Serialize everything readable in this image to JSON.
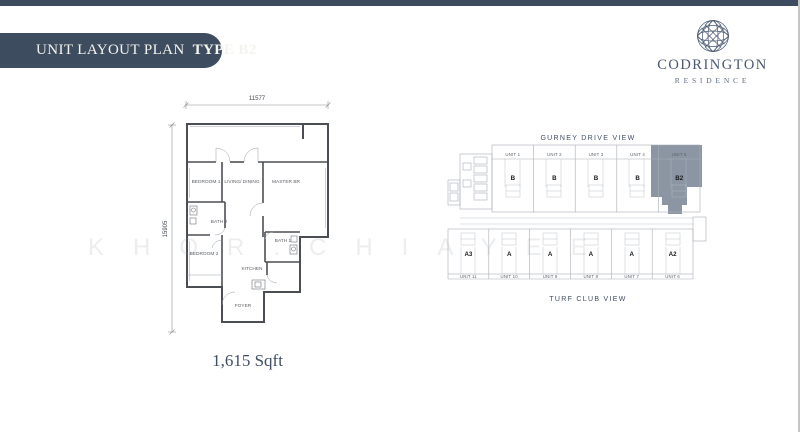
{
  "banner": {
    "title": "UNIT LAYOUT PLAN",
    "unit_type": "TYPE B2"
  },
  "logo": {
    "name": "CODRINGTON",
    "subtitle": "RESIDENCE"
  },
  "floor_plan": {
    "width_dim": "11577",
    "height_dim": "15905",
    "area": "1,615 Sqft",
    "rooms": [
      "BEDROOM 1",
      "LIVING/ DINING",
      "MASTER BR",
      "BATH 2",
      "BEDROOM 2",
      "BATH 1",
      "KITCHEN",
      "FOYER"
    ]
  },
  "site_plan": {
    "top_view_label": "GURNEY DRIVE VIEW",
    "bottom_view_label": "TURF CLUB VIEW",
    "top_units": [
      {
        "name": "UNIT 1",
        "type": "B"
      },
      {
        "name": "UNIT 2",
        "type": "B"
      },
      {
        "name": "UNIT 3",
        "type": "B"
      },
      {
        "name": "UNIT 4",
        "type": "B"
      },
      {
        "name": "UNIT 5",
        "type": "B2",
        "highlighted": true
      }
    ],
    "bottom_units": [
      {
        "name": "UNIT 11",
        "type": "A3"
      },
      {
        "name": "UNIT 10",
        "type": "A"
      },
      {
        "name": "UNIT 9",
        "type": "A"
      },
      {
        "name": "UNIT 8",
        "type": "A"
      },
      {
        "name": "UNIT 7",
        "type": "A"
      },
      {
        "name": "UNIT 6",
        "type": "A2"
      }
    ]
  },
  "watermark": "KHOR.CHIAYEE",
  "colors": {
    "navy": "#3e4c60",
    "logo_navy": "#4a5872",
    "highlight": "#8b95a3"
  }
}
